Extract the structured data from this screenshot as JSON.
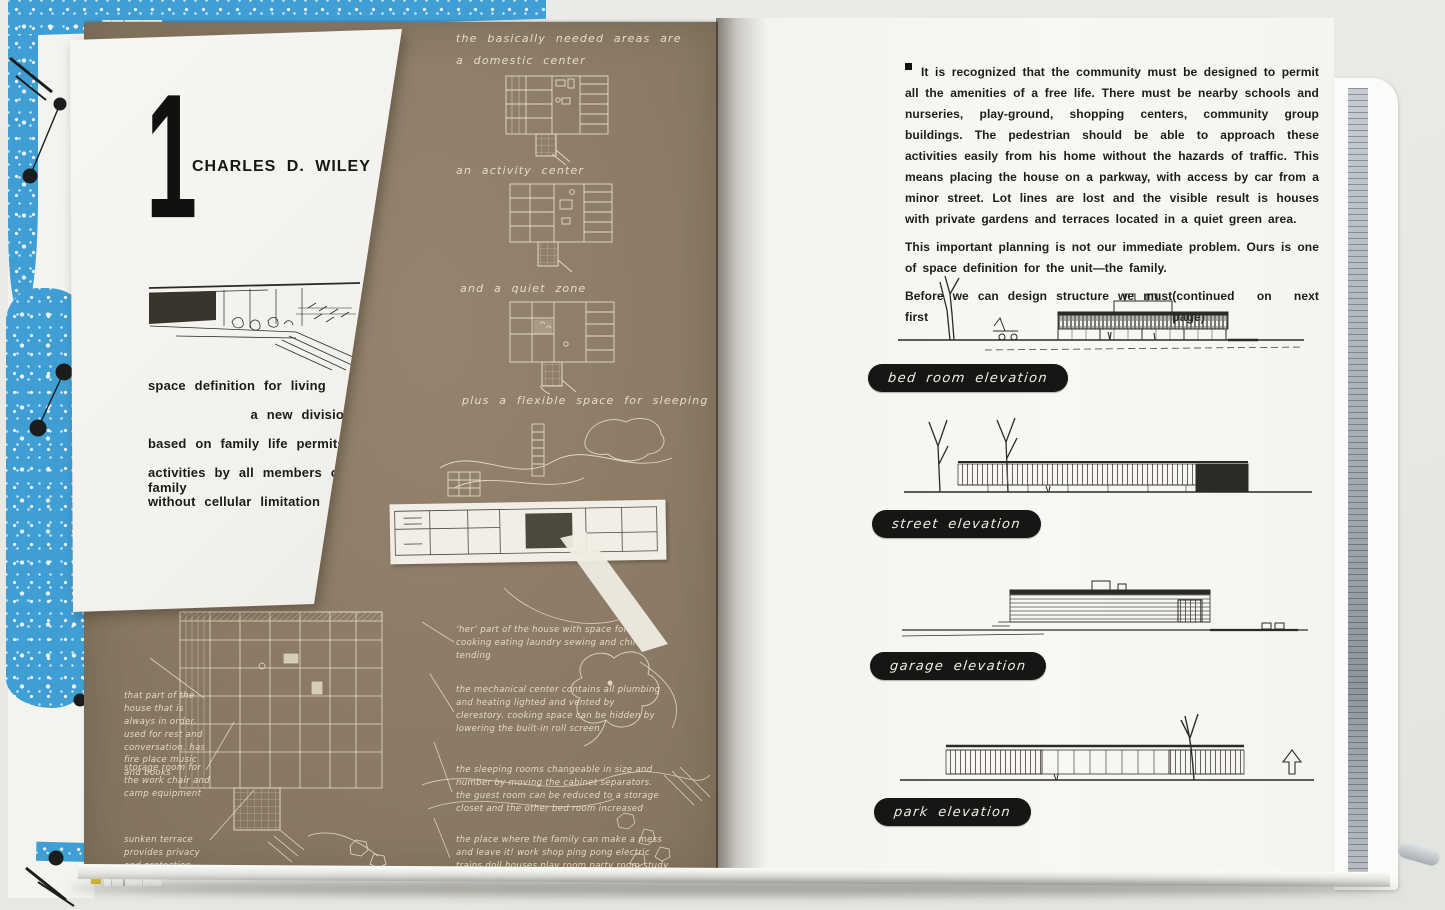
{
  "colors": {
    "background_gray": "#e9eae6",
    "kraft_panel_brown": "#8a7a66",
    "page_white": "#f8f7f3",
    "card_white": "#f4f3ee",
    "cover_blue": "#3f9fd5",
    "edge_yellow": "#e2c838",
    "pill_black": "#161614",
    "ink_black": "#1c1c1c",
    "script_cream": "#ece3cd"
  },
  "left_page": {
    "chapter_number": "1",
    "chapter_author": "CHARLES D. WILEY",
    "intro_lines": [
      "space definition for living",
      "a new division,",
      "based on family life permits varied",
      "activities by all members of the family",
      "without cellular limitation"
    ],
    "kraft_heading": "the basically needed areas are",
    "zone_labels": {
      "domestic": "a domestic center",
      "activity": "an activity center",
      "quiet": "and a quiet zone",
      "sleeping": "plus a flexible space for sleeping"
    },
    "annotations_left": [
      "that part of the house that is always in order. used for rest and conversation. has fire place music and books",
      "storage room for the work chair and camp equipment",
      "sunken terrace provides privacy and protection from the weather"
    ],
    "annotations_right": [
      "‘her’ part of the house with space for cooking eating laundry sewing and child tending",
      "the mechanical center contains all plumbing and heating lighted and vented by clerestory. cooking space can be hidden by lowering the built-in roll screen",
      "the sleeping rooms changeable in size and number by moving the cabinet separators. the guest room can be reduced to a storage closet and the other bed room increased",
      "the place where the family can make a mess and leave it! work shop ping pong electric trains doll houses play room party room study room. the heart of the household given its place"
    ]
  },
  "right_page": {
    "paragraph_1": "It is recognized that the community must be designed to permit all the amenities of a free life. There must be nearby schools and nurseries, play-ground, shopping centers, community group buildings. The pedestrian should be able to approach these activities easily from his home without the hazards of traffic. This means placing the house on a parkway, with access by car from a minor street. Lot lines are lost and the visible result is houses with private gardens and terraces located in a quiet green area.",
    "paragraph_2": "This important planning is not our immediate problem. Ours is one of space definition for the unit—the family.",
    "paragraph_3": "Before we can design structure we must first",
    "continued_note": "(continued on next page)",
    "elevations": [
      {
        "label": "bed room elevation"
      },
      {
        "label": "street elevation"
      },
      {
        "label": "garage elevation"
      },
      {
        "label": "park elevation"
      }
    ]
  }
}
